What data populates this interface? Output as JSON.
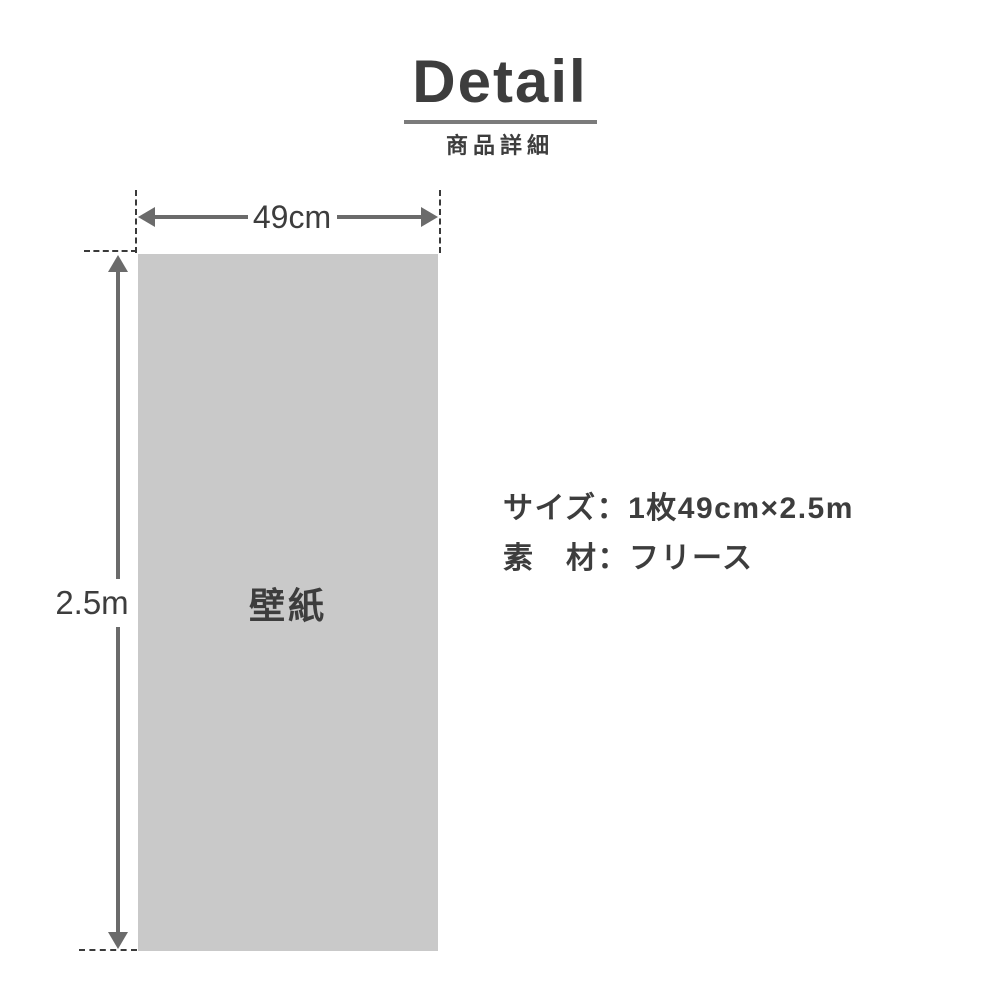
{
  "header": {
    "title": "Detail",
    "subtitle": "商品詳細"
  },
  "diagram": {
    "panel_label": "壁紙",
    "width_label": "49cm",
    "height_label": "2.5m"
  },
  "specs": {
    "size_line": "サイズ：1枚49cm×2.5m",
    "material_line": "素　材：フリース"
  },
  "colors": {
    "text": "#3d3d3d",
    "underline": "#7b7b7b",
    "arrow": "#6b6b6b",
    "dashed_line": "#3a3a3a",
    "panel_fill": "#c9c9c9"
  }
}
